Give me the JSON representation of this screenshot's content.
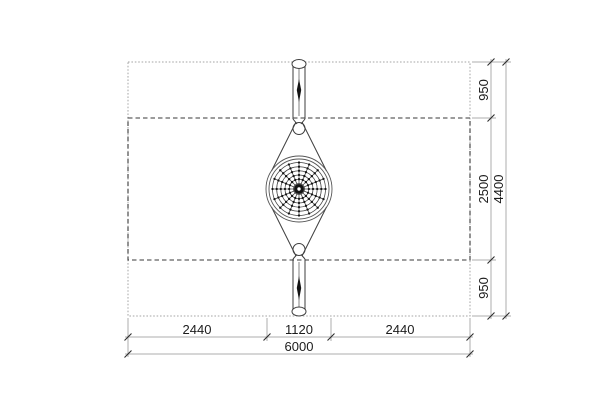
{
  "dims": {
    "bottom": {
      "left": "2440",
      "center": "1120",
      "right": "2440",
      "total": "6000"
    },
    "right": {
      "top": "950",
      "middle": "2500",
      "bottom": "950",
      "total": "4400"
    }
  },
  "colors": {
    "light_line": "#adadad",
    "dark_line": "#3d3d3d",
    "dashed_line": "#3a3a3a",
    "text": "#1c1c1c",
    "black_fill": "#141414",
    "background": "#ffffff"
  },
  "web": {
    "spoke_count": 16,
    "ring_radii": [
      5.5,
      9.8,
      14,
      18.2,
      22.3,
      26.5
    ],
    "dot_ring_radii": [
      9.8,
      14,
      18.2,
      22.3,
      26.5
    ],
    "outer_ring_radii": [
      30,
      33
    ],
    "hub_radius": 5,
    "hub_hole_radius": 1.7,
    "dot_radius": 1.15
  }
}
